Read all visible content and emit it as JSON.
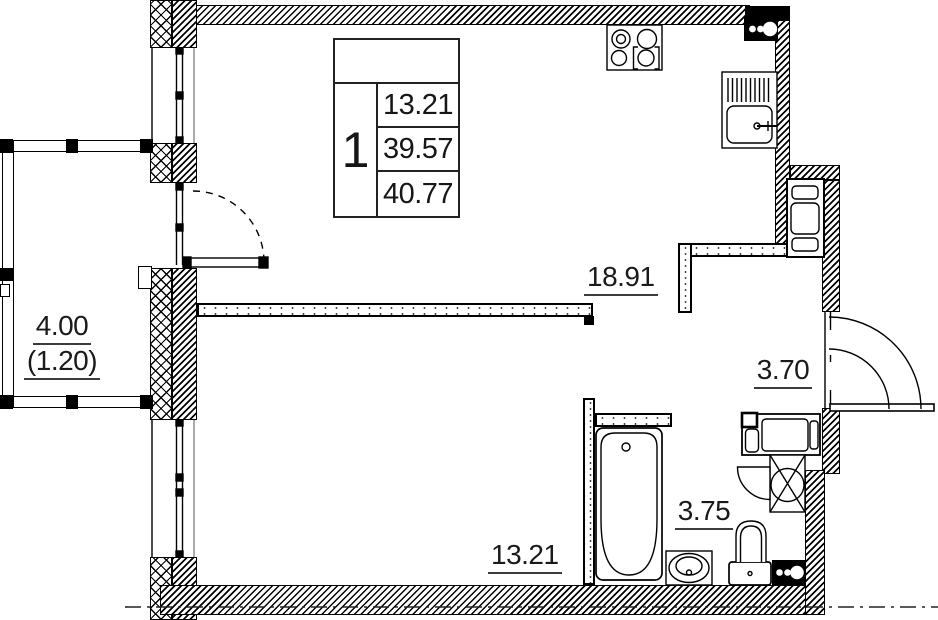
{
  "legend": {
    "rooms_count": "1",
    "living_area": "13.21",
    "apartment_area": "39.57",
    "total_area": "40.77"
  },
  "rooms": {
    "living_kitchen": {
      "area": "18.91"
    },
    "room": {
      "area": "13.21"
    },
    "hallway": {
      "area": "3.70"
    },
    "bathroom": {
      "area": "3.75"
    },
    "balcony": {
      "area": "4.00",
      "reduced": "(1.20)"
    }
  },
  "icons": {
    "fixtures": [
      "stove-icon",
      "kitchen-sink-icon",
      "electrical-panel-icon",
      "cabinet-icon",
      "washing-machine-icon",
      "vent-shaft-icon",
      "bathtub-icon",
      "washbasin-icon",
      "toilet-icon",
      "door-swing-icon",
      "window-icon"
    ]
  },
  "colors": {
    "line": "#000000",
    "background": "#ffffff",
    "label": "#1a1a1a"
  }
}
